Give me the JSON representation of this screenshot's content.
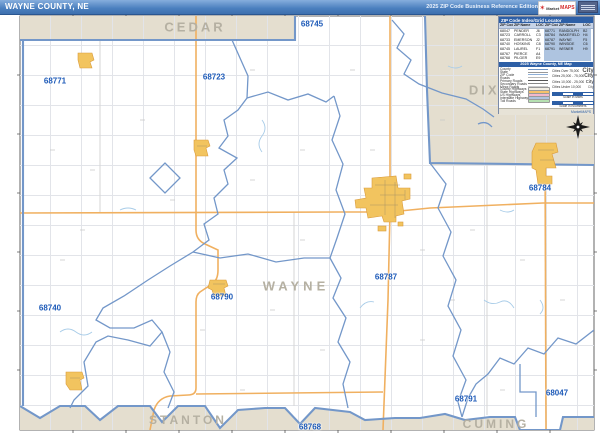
{
  "title_bar": {
    "title": "WAYNE COUNTY, NE",
    "edition": "2025 ZIP Code Business Reference Edition",
    "logo_market": "Market",
    "logo_maps": "MAPS"
  },
  "counties": {
    "top": "CEDAR",
    "top_right": "DIXON",
    "center": "WAYNE",
    "bottom_left": "STANTON",
    "bottom_right": "CUMING"
  },
  "zip_labels": [
    {
      "code": "68745",
      "x": 312,
      "y": 24
    },
    {
      "code": "68771",
      "x": 55,
      "y": 81
    },
    {
      "code": "68723",
      "x": 214,
      "y": 77
    },
    {
      "code": "68784",
      "x": 540,
      "y": 188
    },
    {
      "code": "68787",
      "x": 386,
      "y": 277
    },
    {
      "code": "68790",
      "x": 222,
      "y": 297
    },
    {
      "code": "68740",
      "x": 50,
      "y": 308
    },
    {
      "code": "68768",
      "x": 310,
      "y": 427
    },
    {
      "code": "68791",
      "x": 466,
      "y": 399
    },
    {
      "code": "68047",
      "x": 557,
      "y": 393
    }
  ],
  "index_table": {
    "title": "ZIP Code Index/Grid Locator",
    "headers": [
      "ZIP Code",
      "ZIP Name",
      "LOC",
      "ZIP Code",
      "ZIP Name",
      "LOC"
    ],
    "rows_left": [
      [
        "68047",
        "PENDER",
        "J6"
      ],
      [
        "68723",
        "CARROLL",
        "C3"
      ],
      [
        "68733",
        "EMERSON",
        "J2"
      ],
      [
        "68740",
        "HOSKINS",
        "C8"
      ],
      [
        "68745",
        "LAUREL",
        "F1"
      ],
      [
        "68767",
        "PIERCE",
        "A4"
      ],
      [
        "68768",
        "PILGER",
        "E9"
      ]
    ],
    "rows_right": [
      [
        "68771",
        "RANDOLPH",
        "B2"
      ],
      [
        "68784",
        "WAKEFIELD",
        "H4"
      ],
      [
        "68787",
        "WAYNE",
        "F5"
      ],
      [
        "68790",
        "WINSIDE",
        "C6"
      ],
      [
        "68791",
        "WISNER",
        "H9"
      ]
    ]
  },
  "legend": {
    "title": "2025 Wayne County, NE Map",
    "line_items": [
      {
        "label": "County",
        "type": "line",
        "color": "#6f94c4"
      },
      {
        "label": "State",
        "type": "line",
        "color": "#999999"
      },
      {
        "label": "ZIP Code",
        "type": "line",
        "color": "#8fb0d8"
      },
      {
        "label": "Roads",
        "type": "line",
        "color": "#bbbbbb"
      },
      {
        "label": "Primary Roads",
        "type": "line",
        "color": "#555555"
      },
      {
        "label": "Secondary Roads",
        "type": "line",
        "color": "#888888"
      },
      {
        "label": "Minor Roads",
        "type": "line",
        "color": "#cccccc"
      },
      {
        "label": "County Highways",
        "type": "swatch",
        "color": "#f3efe4"
      },
      {
        "label": "State Highways",
        "type": "swatch",
        "color": "#f5c26b"
      },
      {
        "label": "US Highways",
        "type": "swatch",
        "color": "#f2b8cb"
      },
      {
        "label": "Interstate Highways",
        "type": "swatch",
        "color": "#aec4e0"
      },
      {
        "label": "Toll Roads",
        "type": "swatch",
        "color": "#b5e0b0"
      }
    ],
    "city_items": [
      {
        "label": "Cities Over 75,000",
        "sample": "City"
      },
      {
        "label": "Cities 25,000 - 75,000",
        "sample": "City"
      },
      {
        "label": "Cities 10,000 - 25,000",
        "sample": "City"
      },
      {
        "label": "Cities Under 10,000",
        "sample": "City"
      }
    ],
    "scales": [
      {
        "label": "Scale in Miles"
      },
      {
        "label": "Scale in Kilometers"
      }
    ],
    "footer": "MarketMAPS"
  },
  "colors": {
    "titlebar_blue": "#4a7fbe",
    "neighbor_county_tan": "#e4decf",
    "boundary_blue": "#7397c9",
    "highway_orange": "#f0b060",
    "city_yellow": "#f2c45f",
    "zip_label_blue": "#1d5ab8",
    "county_label_gray": "#b5b0a2",
    "legend_header_blue": "#2d5fa6"
  }
}
